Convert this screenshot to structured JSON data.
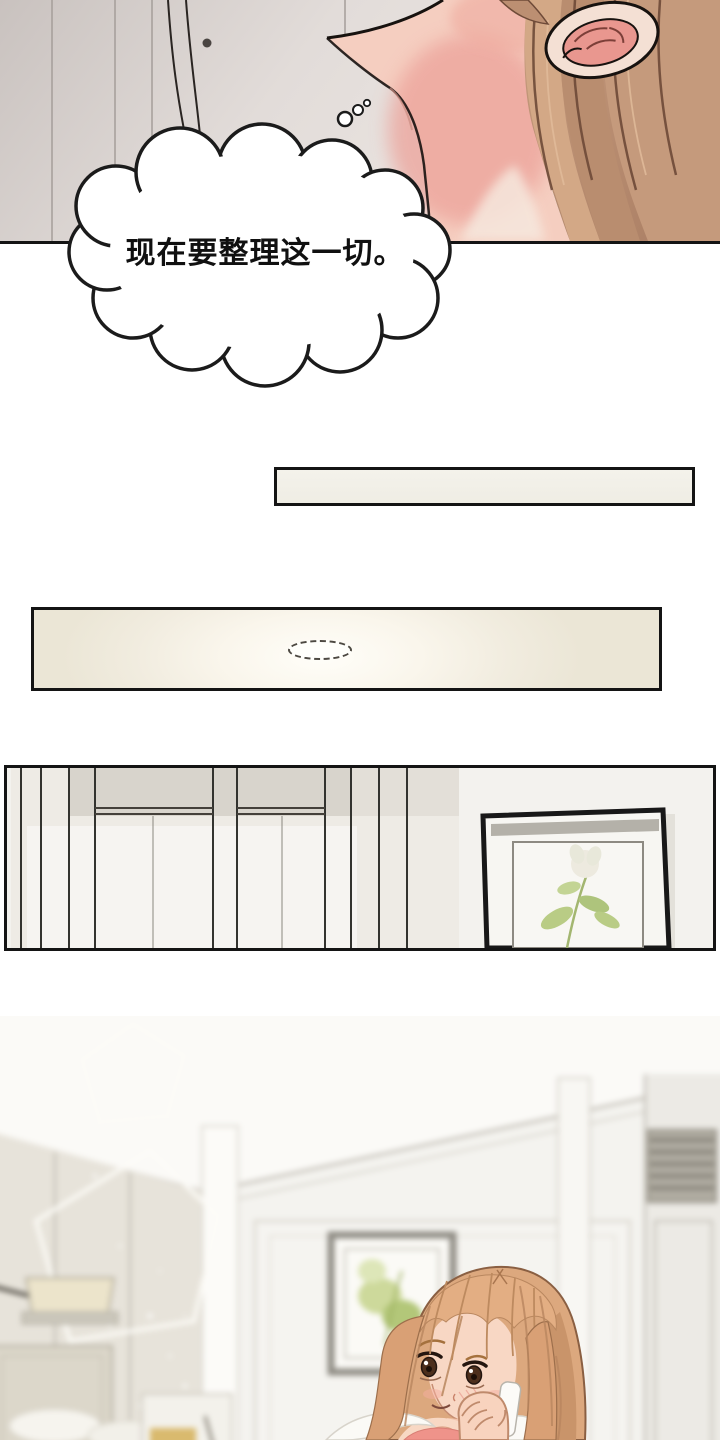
{
  "page": {
    "width": 720,
    "height": 1440,
    "background": "#ffffff"
  },
  "bubbles": {
    "thought": {
      "text": "现在要整理这一切。",
      "fill": "#ffffff",
      "outline": "#1b1b1b"
    },
    "speech": {
      "line1": "离开首尔已经",
      "line2": "20多天...。",
      "border_color": "#8d8d8d",
      "border_style": "dotted"
    }
  },
  "panels": {
    "closeup": {
      "label": "neck-ear-closeup"
    },
    "strip": {
      "label": "blank-cream-strip"
    },
    "ceiling": {
      "label": "ceiling-with-lamp"
    },
    "room": {
      "label": "wardrobe-and-frame-room"
    },
    "bedroom": {
      "label": "blurred-bedroom-with-woman-on-phone"
    }
  },
  "colors": {
    "panel_border": "#141414",
    "cream_panel": "#f2efe6",
    "wall_gray": "#d9d5cd",
    "skin": "#f5cec0",
    "neck_blush": "#eda49b",
    "hair_light": "#d3a886",
    "hair_dark": "#a87c62",
    "woman_hair": "#dca87e",
    "coral_top": "#ef938a",
    "plant_green": "#b9cc85",
    "vent_gray": "#7d7970"
  }
}
